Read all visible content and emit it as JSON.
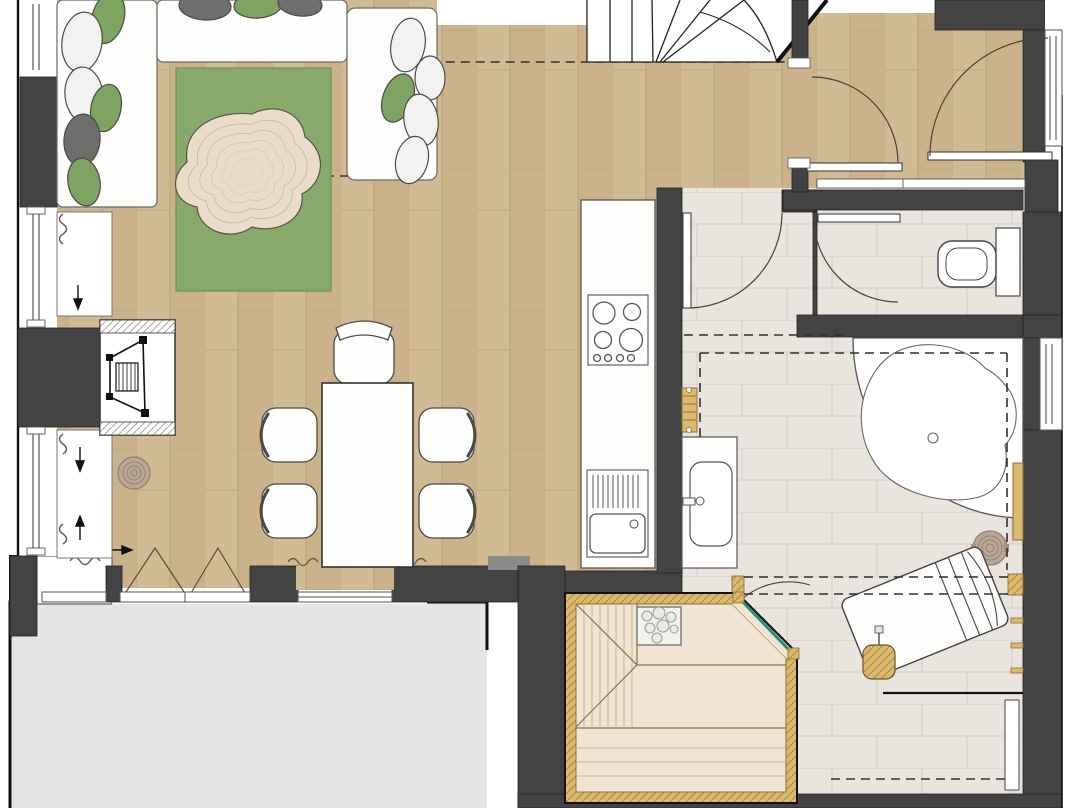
{
  "document": {
    "kind": "architectural-floor-plan",
    "visible_text": [],
    "orientation": "top-down plan view"
  },
  "palette": {
    "wall_dark": "#434343",
    "wall_outline": "#1e1e1e",
    "wood_floor": "#d1bb94",
    "wood_floor_alt": "#cab28a",
    "wood_floor_line": "#b8a177",
    "tile_floor": "#e9e4dd",
    "tile_line": "#d8d1c8",
    "terrace": "#e5e5e3",
    "rug_green": "#87a96b",
    "rug_green_line": "#6d8f54",
    "rug_cream": "#e9dcc8",
    "rug_cream_line": "#c9b49a",
    "cushion_green": "#7fa361",
    "cushion_gray": "#6e6e6c",
    "furniture_white": "#fdfdfc",
    "furniture_line": "#4a4a4a",
    "sauna_wood": "#dbb96e",
    "sauna_wood_line": "#b38d45",
    "sauna_floor": "#efe5d2",
    "sauna_plank_line": "#c8b394",
    "glass_teal": "#2a8c7a",
    "door_arc": "#4a423a",
    "dashed_line": "#33302c",
    "stump": "#b9a795",
    "stump_ring": "#96836f",
    "doormat": "#8a8a8a",
    "curtain": "#6b5a44"
  },
  "legend": {
    "rooms": [
      "living-area",
      "dining-area",
      "kitchen",
      "staircase",
      "hallway",
      "wc",
      "bathroom",
      "sauna",
      "relaxation-area",
      "terrace"
    ],
    "furniture_icons": [
      "corner-sofa",
      "cushions",
      "green-rug",
      "organic-rug",
      "wood-stove-fireplace",
      "stump-side-table",
      "dining-table",
      "dining-chair",
      "armchair",
      "kitchen-counter",
      "cooktop",
      "kitchen-sink",
      "winder-staircase",
      "door-swing",
      "toilet",
      "cistern",
      "washbasin-vanity",
      "towel-radiator",
      "corner-bathtub",
      "wooden-stool",
      "sauna-heater",
      "sauna-bench",
      "sauna-glass-door",
      "lounger",
      "wall-hooks",
      "bench",
      "doormat",
      "window",
      "curtain",
      "roof-slope-dashed-line"
    ]
  }
}
